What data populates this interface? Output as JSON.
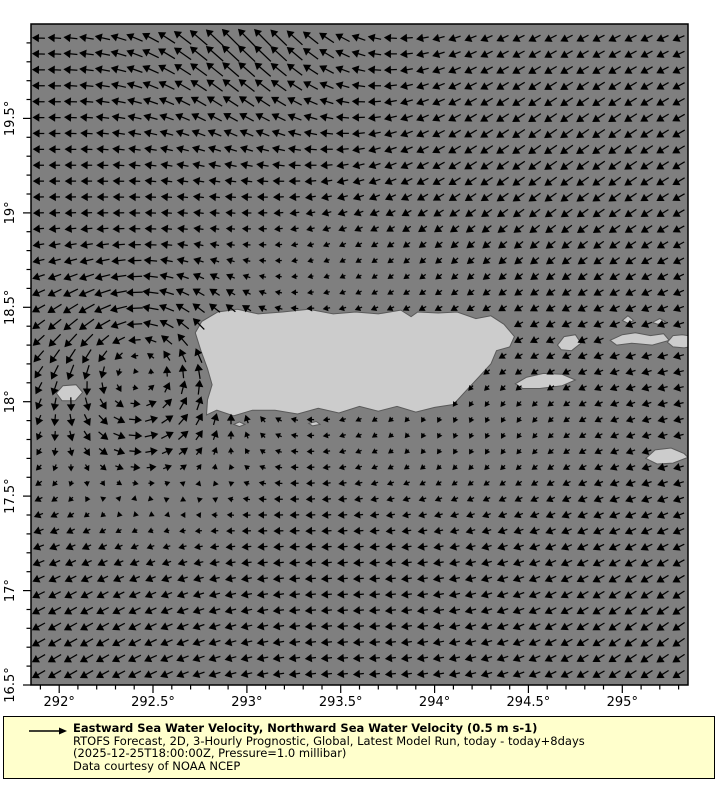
{
  "map": {
    "ocean_color": "#7f7f7f",
    "land_color": "#cccccc",
    "coast_color": "#5a5a5a",
    "frame_color": "#000000",
    "arrow_color": "#000000",
    "lon_min": 291.85,
    "lon_max": 295.35,
    "lat_min": 16.5,
    "lat_max": 20.0,
    "x_ticks": [
      {
        "v": 292.0,
        "label": "292°"
      },
      {
        "v": 292.5,
        "label": "292.5°"
      },
      {
        "v": 293.0,
        "label": "293°"
      },
      {
        "v": 293.5,
        "label": "293.5°"
      },
      {
        "v": 294.0,
        "label": "294°"
      },
      {
        "v": 294.5,
        "label": "294.5°"
      },
      {
        "v": 295.0,
        "label": "295°"
      }
    ],
    "y_ticks": [
      {
        "v": 16.5,
        "label": "16.5°"
      },
      {
        "v": 17.0,
        "label": "17°"
      },
      {
        "v": 17.5,
        "label": "17.5°"
      },
      {
        "v": 18.0,
        "label": "18°"
      },
      {
        "v": 18.5,
        "label": "18.5°"
      },
      {
        "v": 19.0,
        "label": "19°"
      },
      {
        "v": 19.5,
        "label": "19.5°"
      }
    ],
    "minor_tick_step": 0.1,
    "land_polygons": [
      {
        "name": "puerto-rico",
        "pts": [
          [
            292.725,
            18.365
          ],
          [
            292.76,
            18.425
          ],
          [
            292.845,
            18.475
          ],
          [
            292.95,
            18.49
          ],
          [
            293.06,
            18.465
          ],
          [
            293.19,
            18.475
          ],
          [
            293.33,
            18.49
          ],
          [
            293.46,
            18.465
          ],
          [
            293.58,
            18.475
          ],
          [
            293.7,
            18.465
          ],
          [
            293.82,
            18.485
          ],
          [
            293.875,
            18.45
          ],
          [
            293.91,
            18.475
          ],
          [
            294.02,
            18.47
          ],
          [
            294.12,
            18.475
          ],
          [
            294.22,
            18.44
          ],
          [
            294.3,
            18.455
          ],
          [
            294.37,
            18.41
          ],
          [
            294.425,
            18.345
          ],
          [
            294.4,
            18.29
          ],
          [
            294.33,
            18.27
          ],
          [
            294.3,
            18.2
          ],
          [
            294.24,
            18.135
          ],
          [
            294.16,
            18.05
          ],
          [
            294.1,
            17.985
          ],
          [
            294.0,
            17.97
          ],
          [
            293.9,
            17.945
          ],
          [
            293.8,
            17.975
          ],
          [
            293.7,
            17.95
          ],
          [
            293.6,
            17.975
          ],
          [
            293.49,
            17.94
          ],
          [
            293.38,
            17.965
          ],
          [
            293.27,
            17.935
          ],
          [
            293.15,
            17.955
          ],
          [
            293.03,
            17.955
          ],
          [
            292.93,
            17.925
          ],
          [
            292.84,
            17.955
          ],
          [
            292.785,
            17.93
          ],
          [
            292.79,
            18.01
          ],
          [
            292.815,
            18.09
          ],
          [
            292.79,
            18.175
          ],
          [
            292.755,
            18.27
          ]
        ]
      },
      {
        "name": "mona-island",
        "pts": [
          [
            291.985,
            18.045
          ],
          [
            292.02,
            18.085
          ],
          [
            292.09,
            18.09
          ],
          [
            292.125,
            18.05
          ],
          [
            292.085,
            18.005
          ],
          [
            292.015,
            18.005
          ]
        ]
      },
      {
        "name": "vieques",
        "pts": [
          [
            294.43,
            18.095
          ],
          [
            294.49,
            18.13
          ],
          [
            294.58,
            18.15
          ],
          [
            294.68,
            18.145
          ],
          [
            294.75,
            18.115
          ],
          [
            294.68,
            18.085
          ],
          [
            294.56,
            18.07
          ],
          [
            294.47,
            18.07
          ]
        ]
      },
      {
        "name": "culebra",
        "pts": [
          [
            294.655,
            18.3
          ],
          [
            294.69,
            18.345
          ],
          [
            294.75,
            18.355
          ],
          [
            294.78,
            18.31
          ],
          [
            294.73,
            18.27
          ],
          [
            294.675,
            18.275
          ]
        ]
      },
      {
        "name": "st-thomas",
        "pts": [
          [
            294.935,
            18.325
          ],
          [
            295.0,
            18.355
          ],
          [
            295.07,
            18.365
          ],
          [
            295.15,
            18.35
          ],
          [
            295.22,
            18.36
          ],
          [
            295.25,
            18.325
          ],
          [
            295.16,
            18.3
          ],
          [
            295.05,
            18.31
          ],
          [
            294.97,
            18.3
          ]
        ]
      },
      {
        "name": "tortola-edge",
        "pts": [
          [
            295.24,
            18.315
          ],
          [
            295.27,
            18.35
          ],
          [
            295.32,
            18.355
          ],
          [
            295.38,
            18.345
          ],
          [
            295.4,
            18.3
          ],
          [
            295.33,
            18.285
          ],
          [
            295.27,
            18.29
          ]
        ]
      },
      {
        "name": "islet-1",
        "pts": [
          [
            295.0,
            18.43
          ],
          [
            295.03,
            18.455
          ],
          [
            295.06,
            18.43
          ],
          [
            295.03,
            18.415
          ]
        ]
      },
      {
        "name": "islet-2",
        "pts": [
          [
            295.16,
            18.42
          ],
          [
            295.2,
            18.44
          ],
          [
            295.23,
            18.425
          ],
          [
            295.19,
            18.41
          ]
        ]
      },
      {
        "name": "st-croix",
        "pts": [
          [
            295.125,
            17.7
          ],
          [
            295.175,
            17.745
          ],
          [
            295.26,
            17.755
          ],
          [
            295.33,
            17.725
          ],
          [
            295.35,
            17.705
          ],
          [
            295.27,
            17.675
          ],
          [
            295.185,
            17.67
          ]
        ]
      },
      {
        "name": "cay-1",
        "pts": [
          [
            293.33,
            17.885
          ],
          [
            293.37,
            17.895
          ],
          [
            293.39,
            17.88
          ],
          [
            293.35,
            17.872
          ]
        ]
      },
      {
        "name": "cay-2",
        "pts": [
          [
            292.93,
            17.88
          ],
          [
            292.96,
            17.893
          ],
          [
            292.99,
            17.88
          ],
          [
            292.96,
            17.868
          ]
        ]
      }
    ]
  },
  "chart_data": {
    "type": "quiver",
    "title": "Eastward Sea Water Velocity, Northward Sea Water Velocity",
    "reference_vector": {
      "speed_m_s": 0.5,
      "label": "0.5 m s-1"
    },
    "x_axis": {
      "range": [
        291.85,
        295.35
      ],
      "tick_labels": [
        "292°",
        "292.5°",
        "293°",
        "293.5°",
        "294°",
        "294.5°",
        "295°"
      ]
    },
    "y_axis": {
      "range": [
        16.5,
        20.0
      ],
      "tick_labels": [
        "16.5°",
        "17°",
        "17.5°",
        "18°",
        "18.5°",
        "19°",
        "19.5°"
      ]
    },
    "grid": {
      "cols": 41,
      "rows": 41,
      "spacing_px": 16
    },
    "arrow_scale_px_per_m_s": 56,
    "flow_model": {
      "base": {
        "u": -0.17,
        "v": 0.005
      },
      "features": [
        {
          "type": "gauss",
          "lon": 293.0,
          "lat": 20.05,
          "sx": 0.45,
          "sy": 0.45,
          "du": -0.1,
          "dv": 0.34
        },
        {
          "type": "gauss",
          "lon": 292.35,
          "lat": 19.85,
          "sx": 0.45,
          "sy": 0.35,
          "du": -0.06,
          "dv": -0.02
        },
        {
          "type": "gauss",
          "lon": 294.7,
          "lat": 19.3,
          "sx": 1.0,
          "sy": 0.75,
          "du": -0.04,
          "dv": -0.15
        },
        {
          "type": "gauss",
          "lon": 293.6,
          "lat": 18.7,
          "sx": 0.9,
          "sy": 0.22,
          "du": 0.1,
          "dv": 0.0
        },
        {
          "type": "gauss",
          "lon": 294.15,
          "lat": 17.85,
          "sx": 0.55,
          "sy": 0.3,
          "du": 0.14,
          "dv": -0.06
        },
        {
          "type": "gauss",
          "lon": 295.25,
          "lat": 16.75,
          "sx": 0.75,
          "sy": 0.55,
          "du": -0.03,
          "dv": -0.14
        },
        {
          "type": "gauss",
          "lon": 292.0,
          "lat": 16.65,
          "sx": 0.7,
          "sy": 0.5,
          "du": -0.05,
          "dv": -0.13
        },
        {
          "type": "gauss",
          "lon": 292.5,
          "lat": 18.1,
          "sx": 0.35,
          "sy": 0.5,
          "du": 0.17,
          "dv": 0.0
        },
        {
          "type": "vortex",
          "lon": 292.42,
          "lat": 18.15,
          "r": 0.35,
          "strength": 0.42
        }
      ]
    }
  },
  "legend": {
    "bg_color": "#ffffcc",
    "title": "Eastward Sea Water Velocity, Northward Sea Water Velocity (0.5 m s-1)",
    "subtitle": "RTOFS Forecast, 2D, 3-Hourly Prognostic, Global, Latest Model Run, today - today+8days",
    "timestamp_line": "(2025-12-25T18:00:00Z, Pressure=1.0 millibar)",
    "credit": "Data courtesy of NOAA NCEP"
  }
}
